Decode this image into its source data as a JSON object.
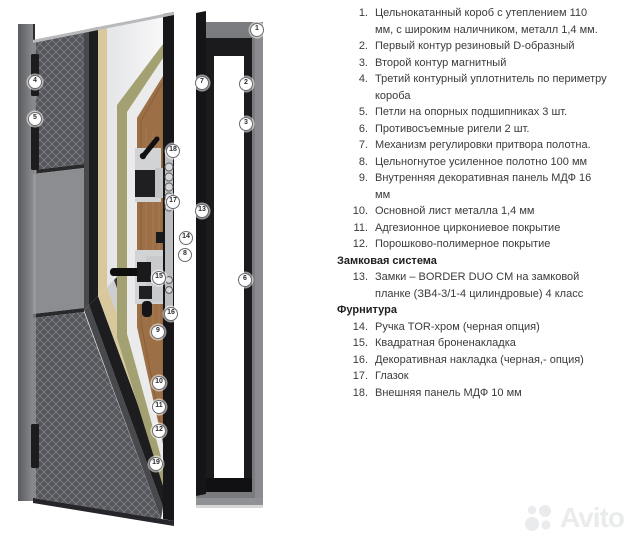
{
  "legend": {
    "entries": [
      {
        "type": "item",
        "num": "1.",
        "text": "Цельнокатанный короб с утеплением 110 мм, с широким наличником, металл 1,4 мм."
      },
      {
        "type": "item",
        "num": "2.",
        "text": "Первый контур резиновый D-образный"
      },
      {
        "type": "item",
        "num": "3.",
        "text": "Второй контур магнитный"
      },
      {
        "type": "item",
        "num": "4.",
        "text": "Третий контурный уплотнитель по периметру короба"
      },
      {
        "type": "item",
        "num": "5.",
        "text": "Петли на опорных подшипниках 3 шт."
      },
      {
        "type": "item",
        "num": "6.",
        "text": "Противосъемные ригели 2 шт."
      },
      {
        "type": "item",
        "num": "7.",
        "text": "Механизм регулировки притвора полотна."
      },
      {
        "type": "item",
        "num": "8.",
        "text": "Цельногнутое усиленное полотно 100 мм"
      },
      {
        "type": "item",
        "num": "9.",
        "text": "Внутренняя декоративная панель МДФ 16 мм"
      },
      {
        "type": "item",
        "num": "10.",
        "text": "Основной лист металла 1,4 мм"
      },
      {
        "type": "item",
        "num": "11.",
        "text": "Адгезионное циркониевое покрытие"
      },
      {
        "type": "item",
        "num": "12.",
        "text": "Порошково-полимерное покрытие"
      },
      {
        "type": "header",
        "text": "Замковая система"
      },
      {
        "type": "item",
        "num": "13.",
        "text": "Замки – BORDER DUO CM на замковой планке (ЗВ4-3/1-4 цилиндровые) 4 класс"
      },
      {
        "type": "header",
        "text": "Фурнитура"
      },
      {
        "type": "item",
        "num": "14.",
        "text": "Ручка TOR-хром (черная опция)"
      },
      {
        "type": "item",
        "num": "15.",
        "text": "Квадратная броненакладка"
      },
      {
        "type": "item",
        "num": "16.",
        "text": "Декоративная накладка (черная,- опция)"
      },
      {
        "type": "item",
        "num": "17.",
        "text": "Глазок"
      },
      {
        "type": "item",
        "num": "18.",
        "text": "Внешняя панель МДФ 10 мм"
      }
    ]
  },
  "diagram": {
    "callouts": [
      {
        "n": "1",
        "x": 256,
        "y": 29
      },
      {
        "n": "2",
        "x": 245,
        "y": 83
      },
      {
        "n": "3",
        "x": 245,
        "y": 123
      },
      {
        "n": "4",
        "x": 34,
        "y": 81
      },
      {
        "n": "5",
        "x": 34,
        "y": 118
      },
      {
        "n": "6",
        "x": 244,
        "y": 279
      },
      {
        "n": "7",
        "x": 201,
        "y": 82
      },
      {
        "n": "8",
        "x": 184,
        "y": 254
      },
      {
        "n": "9",
        "x": 157,
        "y": 331
      },
      {
        "n": "10",
        "x": 158,
        "y": 382
      },
      {
        "n": "11",
        "x": 158,
        "y": 406
      },
      {
        "n": "12",
        "x": 158,
        "y": 430
      },
      {
        "n": "13",
        "x": 201,
        "y": 210
      },
      {
        "n": "14",
        "x": 185,
        "y": 237
      },
      {
        "n": "15",
        "x": 158,
        "y": 277
      },
      {
        "n": "16",
        "x": 170,
        "y": 313
      },
      {
        "n": "17",
        "x": 172,
        "y": 201
      },
      {
        "n": "18",
        "x": 172,
        "y": 150
      },
      {
        "n": "19",
        "x": 155,
        "y": 463
      }
    ]
  },
  "watermark": {
    "text": "Avito"
  },
  "colors": {
    "background": "#ffffff",
    "frame_gray": "#797b7f",
    "leaf_black": "#1d1d1f",
    "insulation_olive": "#a3a172",
    "mdf_brown": "#9c6f46",
    "metal_cream": "#d9c89d",
    "text": "#3b3b3b"
  }
}
